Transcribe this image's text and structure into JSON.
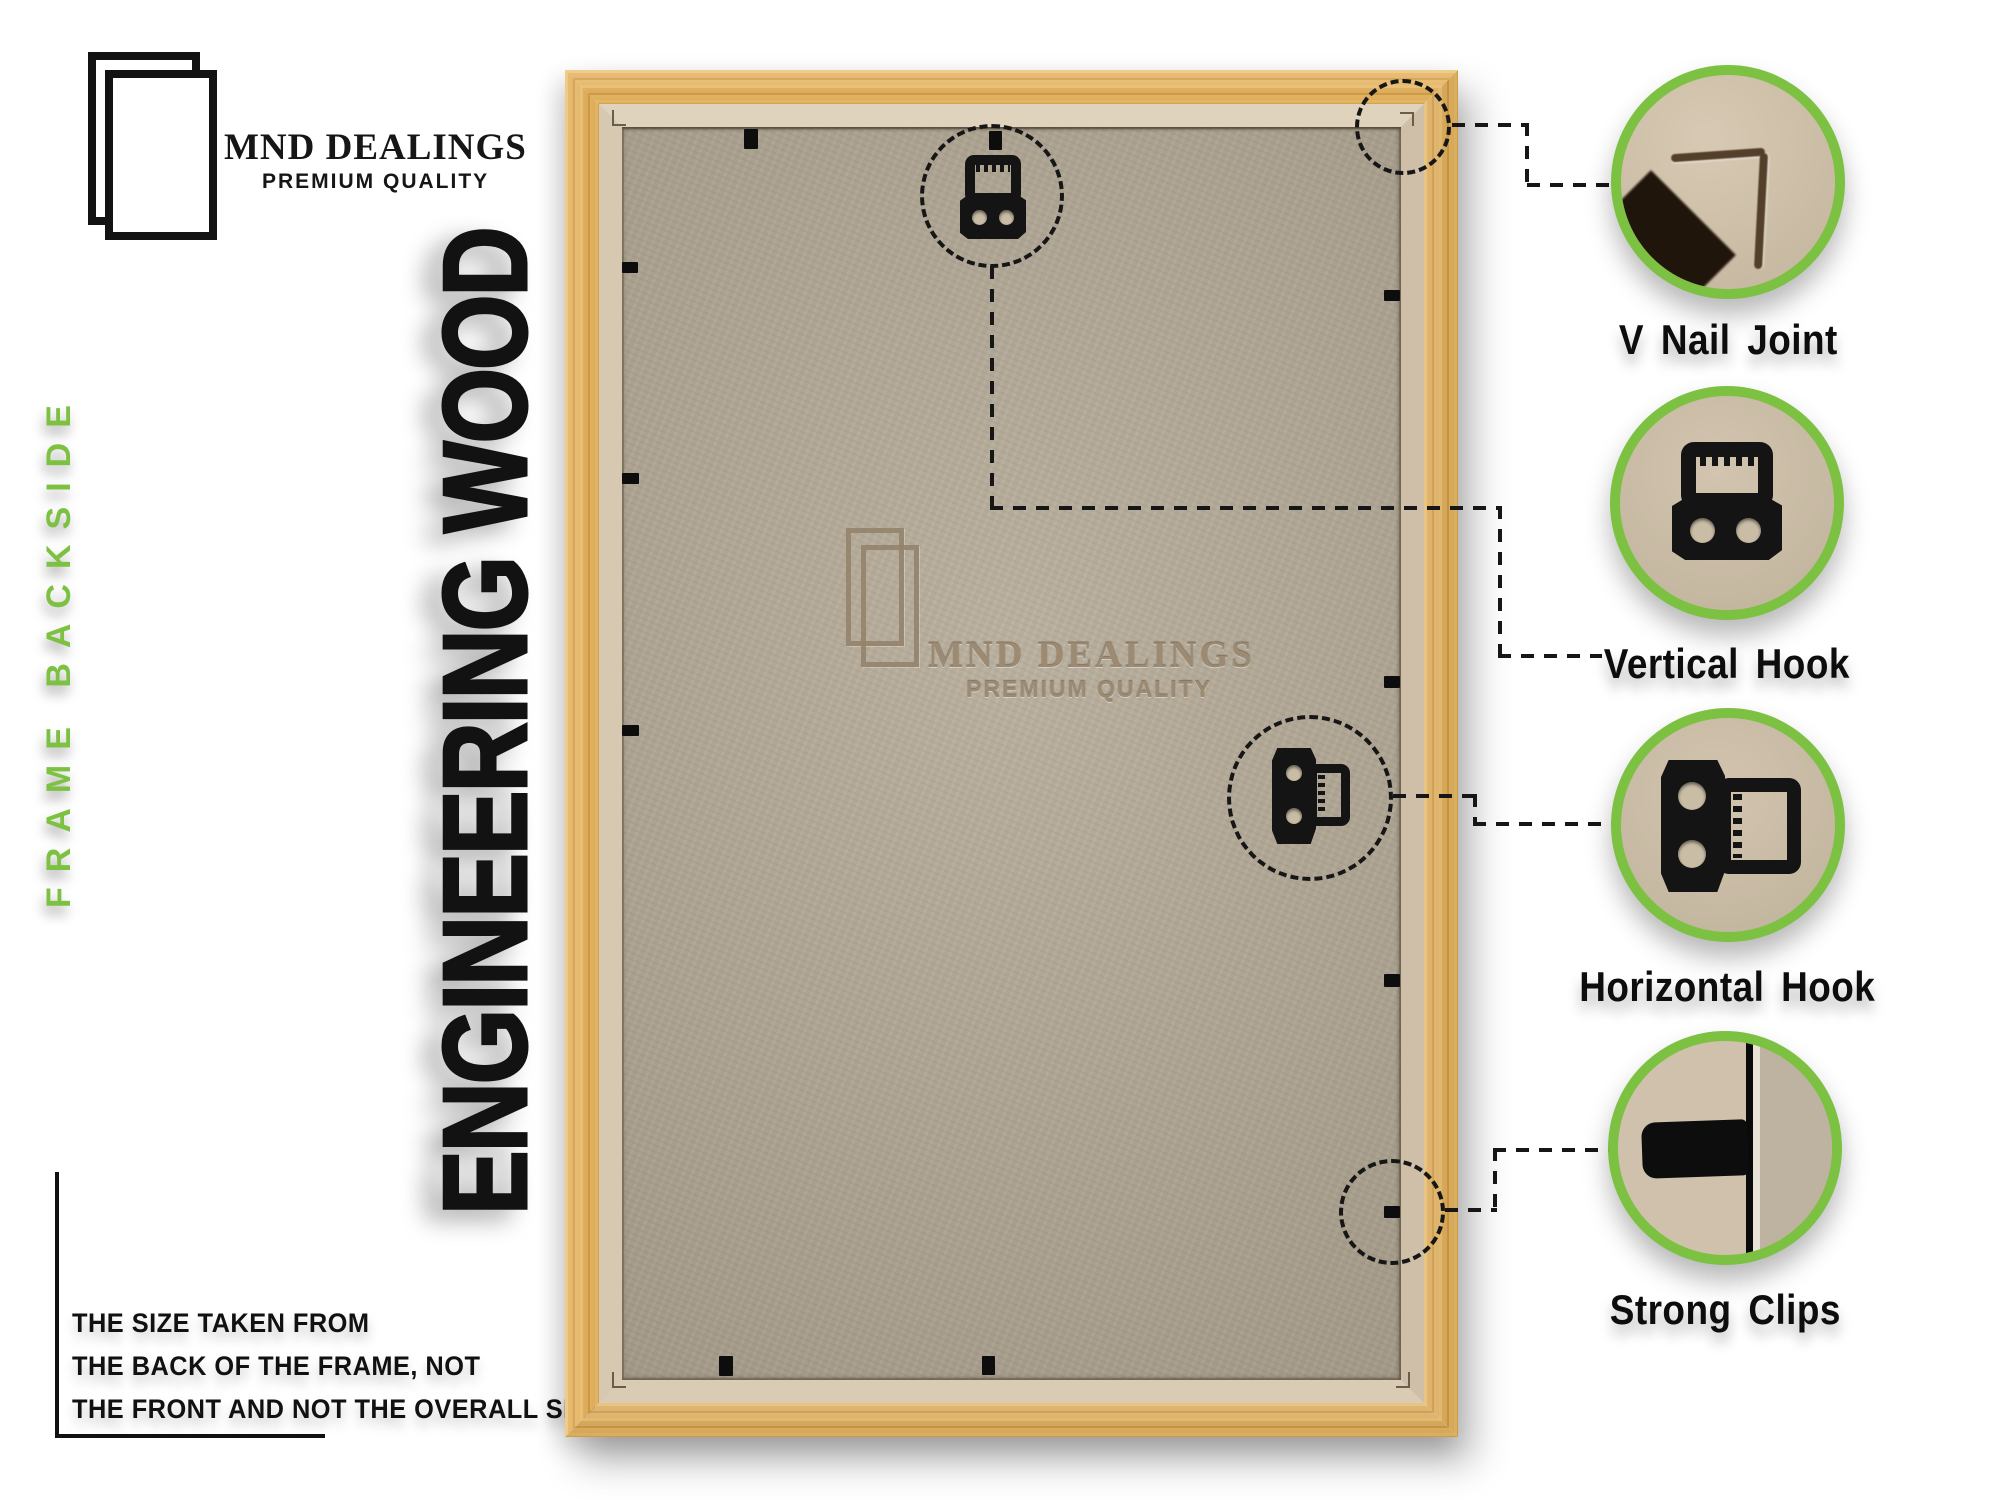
{
  "brand": {
    "name": "MND DEALINGS",
    "tagline": "PREMIUM QUALITY"
  },
  "side_label": "FRAME BACKSIDE",
  "material_heading": "ENGINEERING WOOD",
  "size_note": {
    "line1": "THE SIZE TAKEN FROM",
    "line2": "THE BACK OF THE FRAME, NOT",
    "line3": "THE FRONT AND NOT THE OVERALL SIZE."
  },
  "watermark": {
    "name": "MND DEALINGS",
    "tagline": "PREMIUM QUALITY"
  },
  "callouts": [
    {
      "label": "V Nail Joint"
    },
    {
      "label": "Vertical Hook"
    },
    {
      "label": "Horizontal Hook"
    },
    {
      "label": "Strong Clips"
    }
  ],
  "colors": {
    "accent_green": "#7cc142",
    "frame_wood": "#e2ab4f",
    "cardboard": "#d8c9b2",
    "mdf_back": "#b1a693",
    "annotation_black": "#161616"
  }
}
